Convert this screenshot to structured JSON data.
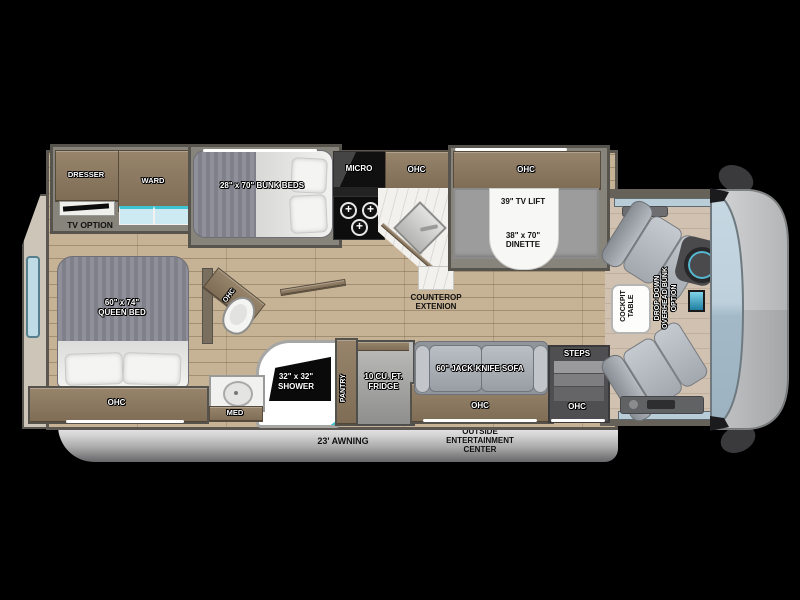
{
  "rooms": {
    "bedroom": {
      "dresser": "DRESSER",
      "ward": "WARD",
      "tv_option": "TV OPTION",
      "bunk_beds": "28\" x 70\" BUNK BEDS",
      "queen_size": "60\" x 74\"",
      "queen_name": "QUEEN BED",
      "ohc": "OHC"
    },
    "kitchen": {
      "micro": "MICRO",
      "ohc": "OHC",
      "counter_l1": "COUNTEROP",
      "counter_l2": "EXTENION",
      "pantry": "PANTRY",
      "fridge_l1": "10 CU. FT.",
      "fridge_l2": "FRIDGE"
    },
    "dinette": {
      "ohc": "OHC",
      "tv_lift": "39\" TV LIFT",
      "size": "38\" x 70\"",
      "name": "DINETTE"
    },
    "bath": {
      "ohc": "OHC",
      "shower_size": "32\" x 32\"",
      "shower": "SHOWER",
      "med": "MED"
    },
    "living": {
      "sofa": "60\" JACK-KNIFE SOFA",
      "ohc": "OHC",
      "steps": "STEPS",
      "steps_ohc": "OHC"
    },
    "cockpit": {
      "table_l1": "COCKPIT",
      "table_l2": "TABLE",
      "bunk_l1": "DROP-DOWN",
      "bunk_l2": "OVERHEAD BUNK",
      "bunk_l3": "OPTION"
    },
    "exterior": {
      "awning": "23' AWNING",
      "outside_l1": "OUTSIDE",
      "outside_l2": "ENTERTAINMENT",
      "outside_l3": "CENTER"
    }
  },
  "colors": {
    "wood": "#8a775e",
    "floor": "#c6b294",
    "teal_accent": "#3fc4d4",
    "mattress_gray": "#8a8a94",
    "windshield_blue": "#b7cbd8",
    "wall_gray": "#87847c"
  }
}
